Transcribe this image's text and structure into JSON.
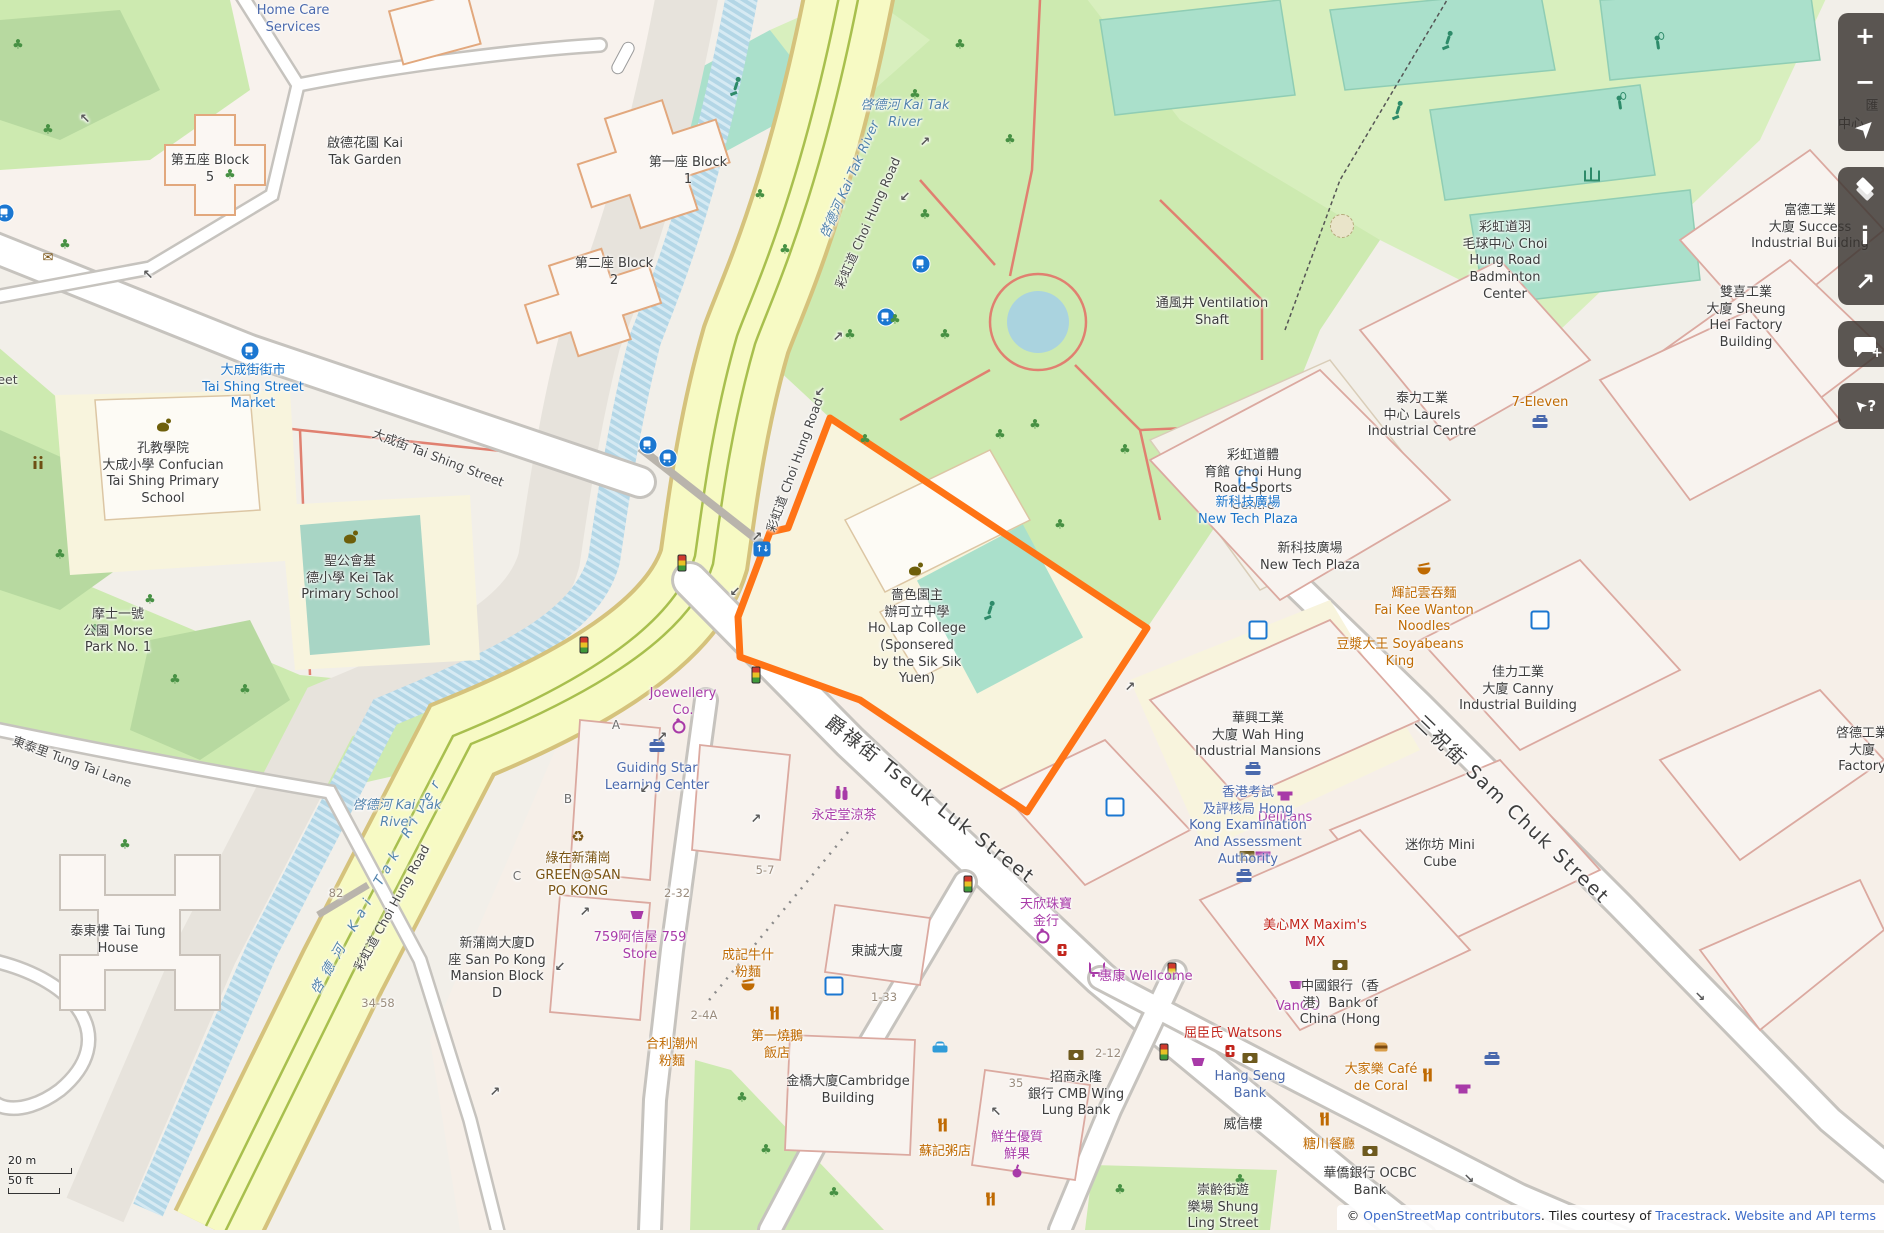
{
  "app": "OpenStreetMap map view",
  "colors": {
    "highlight_orange": "#ff7315",
    "park_green": "#cdeab0",
    "rec_green": "#d8efbe",
    "pitch_teal": "#aae0cb",
    "road_yellow": "#f7fac4",
    "river_blue": "#b3d6e6",
    "school_yellow": "#f8f4dd",
    "control_bg": "rgba(56,51,47,0.82)",
    "transit_blue": "#1a73c8",
    "shop_purple": "#a83aa8",
    "food_orange": "#bf6a02"
  },
  "controls": [
    {
      "group": 1,
      "name": "zoom-in-button",
      "glyph": "+",
      "style": "plain"
    },
    {
      "group": 1,
      "name": "zoom-out-button",
      "glyph": "−",
      "style": "plain"
    },
    {
      "group": 1,
      "name": "geolocate-button",
      "glyph": "➤",
      "style": "rot45"
    },
    {
      "group": 2,
      "name": "layers-button",
      "glyph": "",
      "style": "layers"
    },
    {
      "group": 2,
      "name": "info-button",
      "glyph": "i",
      "style": "plain"
    },
    {
      "group": 2,
      "name": "share-button",
      "glyph": "↗",
      "style": "plain"
    },
    {
      "group": 3,
      "name": "add-note-button",
      "glyph": "",
      "style": "bubble"
    },
    {
      "group": 4,
      "name": "query-features-button",
      "glyph": "➤?",
      "style": "query"
    }
  ],
  "scale": {
    "metric": "20 m",
    "imperial": "50 ft"
  },
  "attribution": {
    "prefix": "© ",
    "link_osm": "OpenStreetMap contributors",
    "middle": ". Tiles courtesy of ",
    "link_tiles": "Tracestrack",
    "dot": ". ",
    "link_terms": "Website and API terms"
  },
  "highlighted_feature": "嗇色園主辦可立中學 Ho Lap College (Sponsered by the Sik Sik Yuen)",
  "labels": [
    {
      "t": "Home Care\nServices",
      "x": 293,
      "y": 3,
      "c": "blue2"
    },
    {
      "t": "第五座 Block\n5",
      "x": 210,
      "y": 153,
      "c": "name"
    },
    {
      "t": "啟德花園 Kai\nTak Garden",
      "x": 365,
      "y": 136,
      "c": "name"
    },
    {
      "t": "第一座 Block\n1",
      "x": 688,
      "y": 155,
      "c": "name"
    },
    {
      "t": "第二座 Block\n2",
      "x": 614,
      "y": 256,
      "c": "name"
    },
    {
      "t": "啓德河 Kai Tak\nRiver",
      "x": 905,
      "y": 98,
      "c": "water"
    },
    {
      "t": "啓德河 Kai Tak River",
      "x": 851,
      "y": 180,
      "c": "water",
      "r": -66
    },
    {
      "t": "彩虹道 Choi Hung Road",
      "x": 868,
      "y": 223,
      "c": "road",
      "r": -66
    },
    {
      "t": "彩虹道 Choi Hung Road",
      "x": 795,
      "y": 465,
      "c": "road",
      "r": -70
    },
    {
      "t": "彩虹道 Choi Hung Road",
      "x": 392,
      "y": 908,
      "c": "road",
      "r": -61
    },
    {
      "t": "啓德河 Kai Tak\nRiver",
      "x": 397,
      "y": 798,
      "c": "water"
    },
    {
      "t": "啓德河 Kai Tak River",
      "x": 378,
      "y": 885,
      "c": "water riverlong",
      "r": -60
    },
    {
      "t": "大成街街市\nTai Shing Street\nMarket",
      "x": 253,
      "y": 363,
      "c": "blue1"
    },
    {
      "t": "大成街 Tai Shing Street",
      "x": -52,
      "y": 372,
      "c": "road"
    },
    {
      "t": "大成街 Tai Shing Street",
      "x": 438,
      "y": 458,
      "c": "road",
      "r": 21
    },
    {
      "t": "孔教學院\n大成小學 Confucian\nTai Shing Primary\nSchool",
      "x": 163,
      "y": 441,
      "c": "name"
    },
    {
      "t": "聖公會基\n德小學 Kei Tak\nPrimary School",
      "x": 350,
      "y": 554,
      "c": "name"
    },
    {
      "t": "摩士一號\n公園 Morse\nPark No. 1",
      "x": 118,
      "y": 607,
      "c": "name"
    },
    {
      "t": "東泰里 Tung Tai Lane",
      "x": 72,
      "y": 762,
      "c": "road",
      "r": 20
    },
    {
      "t": "泰東樓 Tai Tung\nHouse",
      "x": 118,
      "y": 924,
      "c": "name"
    },
    {
      "t": "新蒲崗大廈D\n座 San Po Kong\nMansion Block\nD",
      "x": 497,
      "y": 936,
      "c": "name"
    },
    {
      "t": "82",
      "x": 336,
      "y": 886,
      "c": "hnum"
    },
    {
      "t": "34-58",
      "x": 378,
      "y": 996,
      "c": "hnum"
    },
    {
      "t": "Joewellery\nCo.",
      "x": 683,
      "y": 686,
      "c": "shop"
    },
    {
      "t": "Guiding Star\nLearning Center",
      "x": 657,
      "y": 761,
      "c": "blue2"
    },
    {
      "t": "綠在新蒲崗\nGREEN@SAN\nPO KONG",
      "x": 578,
      "y": 851,
      "c": "brown"
    },
    {
      "t": "759阿信屋 759\nStore",
      "x": 640,
      "y": 930,
      "c": "shop"
    },
    {
      "t": "A",
      "x": 616,
      "y": 718,
      "c": "letter"
    },
    {
      "t": "B",
      "x": 568,
      "y": 792,
      "c": "letter"
    },
    {
      "t": "C",
      "x": 517,
      "y": 869,
      "c": "letter"
    },
    {
      "t": "2-32",
      "x": 677,
      "y": 886,
      "c": "hnum"
    },
    {
      "t": "5-7",
      "x": 765,
      "y": 863,
      "c": "hnum"
    },
    {
      "t": "成記牛什\n粉麵",
      "x": 748,
      "y": 948,
      "c": "food"
    },
    {
      "t": "2-4A",
      "x": 704,
      "y": 1008,
      "c": "hnum"
    },
    {
      "t": "永定堂涼茶",
      "x": 844,
      "y": 808,
      "c": "shop"
    },
    {
      "t": "爵祿街 Tseuk Luk Street",
      "x": 930,
      "y": 800,
      "c": "roadbig",
      "r": 38
    },
    {
      "t": "東誠大廈",
      "x": 877,
      "y": 944,
      "c": "name"
    },
    {
      "t": "1-33",
      "x": 884,
      "y": 990,
      "c": "hnum"
    },
    {
      "t": "嗇色園主\n辦可立中學\nHo Lap College\n(Sponsered\nby the Sik Sik\nYuen)",
      "x": 917,
      "y": 588,
      "c": "name"
    },
    {
      "t": "通風井 Ventilation\nShaft",
      "x": 1212,
      "y": 296,
      "c": "name"
    },
    {
      "t": "彩虹道體\n育館 Choi Hung\nRoad Sports\nCentre",
      "x": 1253,
      "y": 448,
      "c": "name"
    },
    {
      "t": "彩虹道羽\n毛球中心 Choi\nHung Road\nBadminton\nCenter",
      "x": 1505,
      "y": 220,
      "c": "name"
    },
    {
      "t": "富德工業\n大廈 Success\nIndustrial Building",
      "x": 1810,
      "y": 203,
      "c": "name"
    },
    {
      "t": "雙喜工業\n大廈 Sheung\nHei Factory\nBuilding",
      "x": 1746,
      "y": 285,
      "c": "name"
    },
    {
      "t": "匯",
      "x": 1872,
      "y": 99,
      "c": "name"
    },
    {
      "t": "中心",
      "x": 1851,
      "y": 117,
      "c": "name"
    },
    {
      "t": "泰力工業\n中心 Laurels\nIndustrial Centre",
      "x": 1422,
      "y": 391,
      "c": "name"
    },
    {
      "t": "7-Eleven",
      "x": 1540,
      "y": 395,
      "c": "food"
    },
    {
      "t": "新科技廣場\nNew Tech Plaza",
      "x": 1248,
      "y": 495,
      "c": "blue1"
    },
    {
      "t": "新科技廣場\nNew Tech Plaza",
      "x": 1310,
      "y": 541,
      "c": "name"
    },
    {
      "t": "輝記雲吞麵\nFai Kee Wanton\nNoodles",
      "x": 1424,
      "y": 586,
      "c": "food"
    },
    {
      "t": "豆漿大王 Soyabeans\nKing",
      "x": 1400,
      "y": 637,
      "c": "food"
    },
    {
      "t": "佳力工業\n大廈 Canny\nIndustrial Building",
      "x": 1518,
      "y": 665,
      "c": "name"
    },
    {
      "t": "華興工業\n大廈 Wah Hing\nIndustrial Mansions",
      "x": 1258,
      "y": 711,
      "c": "name"
    },
    {
      "t": "三祝街 Sam Chuk Street",
      "x": 1512,
      "y": 810,
      "c": "roadbig",
      "r": 44
    },
    {
      "t": "迷你坊 Mini\nCube",
      "x": 1440,
      "y": 838,
      "c": "name"
    },
    {
      "t": "DeliFans",
      "x": 1285,
      "y": 810,
      "c": "shop"
    },
    {
      "t": "香港考試\n及評核局 Hong\nKong Examination\nAnd Assessment\nAuthority",
      "x": 1248,
      "y": 785,
      "c": "blue2"
    },
    {
      "t": "惠康 Wellcome",
      "x": 1146,
      "y": 969,
      "c": "shop"
    },
    {
      "t": "VanGO",
      "x": 1298,
      "y": 999,
      "c": "shop"
    },
    {
      "t": "屈臣氏 Watsons",
      "x": 1233,
      "y": 1026,
      "c": "red"
    },
    {
      "t": "Hang Seng\nBank",
      "x": 1250,
      "y": 1069,
      "c": "blue2"
    },
    {
      "t": "威信樓",
      "x": 1243,
      "y": 1117,
      "c": "name"
    },
    {
      "t": "大家樂 Café\nde Coral",
      "x": 1381,
      "y": 1062,
      "c": "food"
    },
    {
      "t": "糖川餐廳",
      "x": 1329,
      "y": 1137,
      "c": "food"
    },
    {
      "t": "華僑銀行 OCBC\nBank",
      "x": 1370,
      "y": 1166,
      "c": "name"
    },
    {
      "t": "崇齡街遊\n樂場 Shung\nLing Street",
      "x": 1223,
      "y": 1183,
      "c": "name"
    },
    {
      "t": "美心MX Maxim's\nMX",
      "x": 1315,
      "y": 918,
      "c": "red"
    },
    {
      "t": "中國銀行（香\n港）Bank of\nChina (Hong",
      "x": 1340,
      "y": 979,
      "c": "name"
    },
    {
      "t": "啓德工業\n大廈\nFactory",
      "x": 1862,
      "y": 726,
      "c": "name"
    },
    {
      "t": "蘇記粥店",
      "x": 945,
      "y": 1144,
      "c": "food"
    },
    {
      "t": "鮮生優質\n鮮果",
      "x": 1017,
      "y": 1130,
      "c": "shop"
    },
    {
      "t": "金橋大廈Cambridge\nBuilding",
      "x": 848,
      "y": 1074,
      "c": "name"
    },
    {
      "t": "第一燒鵝\n飯店",
      "x": 777,
      "y": 1029,
      "c": "food"
    },
    {
      "t": "合利潮州\n粉麵",
      "x": 672,
      "y": 1037,
      "c": "food"
    },
    {
      "t": "天欣珠寶\n金行",
      "x": 1046,
      "y": 897,
      "c": "shop"
    },
    {
      "t": "招商永隆\n銀行 CMB Wing\nLung Bank",
      "x": 1076,
      "y": 1070,
      "c": "name"
    },
    {
      "t": "35",
      "x": 1016,
      "y": 1076,
      "c": "hnum"
    },
    {
      "t": "2-12",
      "x": 1108,
      "y": 1046,
      "c": "hnum"
    }
  ],
  "arrows": [
    {
      "t": "↗",
      "x": 925,
      "y": 135
    },
    {
      "t": "↙",
      "x": 905,
      "y": 190
    },
    {
      "t": "↗",
      "x": 838,
      "y": 330
    },
    {
      "t": "↙",
      "x": 820,
      "y": 385
    },
    {
      "t": "↗",
      "x": 757,
      "y": 530
    },
    {
      "t": "↙",
      "x": 735,
      "y": 585
    },
    {
      "t": "↗",
      "x": 662,
      "y": 730
    },
    {
      "t": "↙",
      "x": 645,
      "y": 782
    },
    {
      "t": "↗",
      "x": 585,
      "y": 905
    },
    {
      "t": "↙",
      "x": 560,
      "y": 960
    },
    {
      "t": "↗",
      "x": 495,
      "y": 1085
    },
    {
      "t": "↗",
      "x": 756,
      "y": 812
    },
    {
      "t": "↗",
      "x": 1130,
      "y": 680
    },
    {
      "t": "↖",
      "x": 996,
      "y": 1105
    },
    {
      "t": "↘",
      "x": 1469,
      "y": 1172
    },
    {
      "t": "↖",
      "x": 148,
      "y": 268
    },
    {
      "t": "↖",
      "x": 85,
      "y": 112
    },
    {
      "t": "↘",
      "x": 1700,
      "y": 990
    }
  ],
  "icons": [
    {
      "k": "bus",
      "x": 5,
      "y": 213
    },
    {
      "k": "bus",
      "x": 250,
      "y": 351
    },
    {
      "k": "bus",
      "x": 648,
      "y": 445
    },
    {
      "k": "bus",
      "x": 668,
      "y": 458
    },
    {
      "k": "bus",
      "x": 921,
      "y": 264
    },
    {
      "k": "bus",
      "x": 886,
      "y": 317
    },
    {
      "k": "metro",
      "x": 762,
      "y": 549
    },
    {
      "k": "traffic",
      "x": 682,
      "y": 563
    },
    {
      "k": "traffic",
      "x": 756,
      "y": 675
    },
    {
      "k": "traffic",
      "x": 584,
      "y": 645
    },
    {
      "k": "traffic",
      "x": 968,
      "y": 884
    },
    {
      "k": "traffic",
      "x": 1172,
      "y": 971
    },
    {
      "k": "traffic",
      "x": 1164,
      "y": 1052
    },
    {
      "k": "parking",
      "x": 1248,
      "y": 479
    },
    {
      "k": "parking",
      "x": 1258,
      "y": 630
    },
    {
      "k": "parking",
      "x": 1540,
      "y": 620
    },
    {
      "k": "parking",
      "x": 1115,
      "y": 807
    },
    {
      "k": "parking",
      "x": 834,
      "y": 986
    },
    {
      "k": "school",
      "x": 163,
      "y": 427
    },
    {
      "k": "school",
      "x": 350,
      "y": 539
    },
    {
      "k": "school",
      "x": 915,
      "y": 571
    },
    {
      "k": "case",
      "x": 657,
      "y": 747
    },
    {
      "k": "case",
      "x": 1253,
      "y": 770
    },
    {
      "k": "case",
      "x": 1540,
      "y": 423
    },
    {
      "k": "case",
      "x": 1244,
      "y": 877
    },
    {
      "k": "case",
      "x": 1492,
      "y": 1060
    },
    {
      "k": "cart",
      "x": 1097,
      "y": 968
    },
    {
      "k": "basket",
      "x": 637,
      "y": 915
    },
    {
      "k": "basket",
      "x": 1296,
      "y": 985
    },
    {
      "k": "basket",
      "x": 1198,
      "y": 1062
    },
    {
      "k": "recycle",
      "x": 578,
      "y": 837,
      "g": "♻"
    },
    {
      "k": "toilets",
      "x": 35,
      "y": 465
    },
    {
      "k": "rest",
      "x": 777,
      "y": 1013
    },
    {
      "k": "rest",
      "x": 945,
      "y": 1125
    },
    {
      "k": "rest",
      "x": 1327,
      "y": 1119
    },
    {
      "k": "rest",
      "x": 993,
      "y": 1199
    },
    {
      "k": "rest",
      "x": 1430,
      "y": 1075
    },
    {
      "k": "bowl",
      "x": 748,
      "y": 987
    },
    {
      "k": "bowl",
      "x": 1424,
      "y": 571
    },
    {
      "k": "drink",
      "x": 838,
      "y": 794
    },
    {
      "k": "ring",
      "x": 1043,
      "y": 937
    },
    {
      "k": "ring",
      "x": 679,
      "y": 727
    },
    {
      "k": "pharm",
      "x": 1062,
      "y": 950
    },
    {
      "k": "pharm",
      "x": 1230,
      "y": 1051
    },
    {
      "k": "bank",
      "x": 1076,
      "y": 1055
    },
    {
      "k": "bank",
      "x": 1250,
      "y": 1058
    },
    {
      "k": "bank",
      "x": 1370,
      "y": 1151
    },
    {
      "k": "bank",
      "x": 1340,
      "y": 965
    },
    {
      "k": "bank",
      "x": 1247,
      "y": 856
    },
    {
      "k": "taxi",
      "x": 940,
      "y": 1049
    },
    {
      "k": "apple",
      "x": 1017,
      "y": 1173
    },
    {
      "k": "tshirt",
      "x": 1285,
      "y": 796
    },
    {
      "k": "tshirt",
      "x": 1463,
      "y": 1089
    },
    {
      "k": "tshirt",
      "x": 1263,
      "y": 856
    },
    {
      "k": "burger",
      "x": 1381,
      "y": 1047
    },
    {
      "k": "post",
      "x": 48,
      "y": 258,
      "g": "✉"
    },
    {
      "k": "person",
      "x": 736,
      "y": 86
    },
    {
      "k": "person",
      "x": 1448,
      "y": 40
    },
    {
      "k": "person",
      "x": 1398,
      "y": 110
    },
    {
      "k": "person",
      "x": 990,
      "y": 610
    },
    {
      "k": "bad",
      "x": 1658,
      "y": 45
    },
    {
      "k": "bad",
      "x": 1620,
      "y": 105
    },
    {
      "k": "net",
      "x": 1592,
      "y": 176
    },
    {
      "k": "garden",
      "x": 1342,
      "y": 226
    }
  ],
  "trees": [
    [
      18,
      45
    ],
    [
      48,
      130
    ],
    [
      230,
      175
    ],
    [
      65,
      245
    ],
    [
      60,
      555
    ],
    [
      150,
      600
    ],
    [
      95,
      630
    ],
    [
      175,
      680
    ],
    [
      245,
      690
    ],
    [
      125,
      845
    ],
    [
      915,
      95
    ],
    [
      960,
      45
    ],
    [
      1010,
      140
    ],
    [
      925,
      215
    ],
    [
      895,
      320
    ],
    [
      945,
      335
    ],
    [
      1035,
      425
    ],
    [
      1125,
      450
    ],
    [
      760,
      195
    ],
    [
      785,
      250
    ],
    [
      850,
      335
    ],
    [
      865,
      440
    ],
    [
      1000,
      435
    ],
    [
      1060,
      525
    ],
    [
      742,
      1098
    ],
    [
      766,
      1150
    ],
    [
      834,
      1193
    ],
    [
      1120,
      1190
    ],
    [
      1240,
      1180
    ]
  ]
}
